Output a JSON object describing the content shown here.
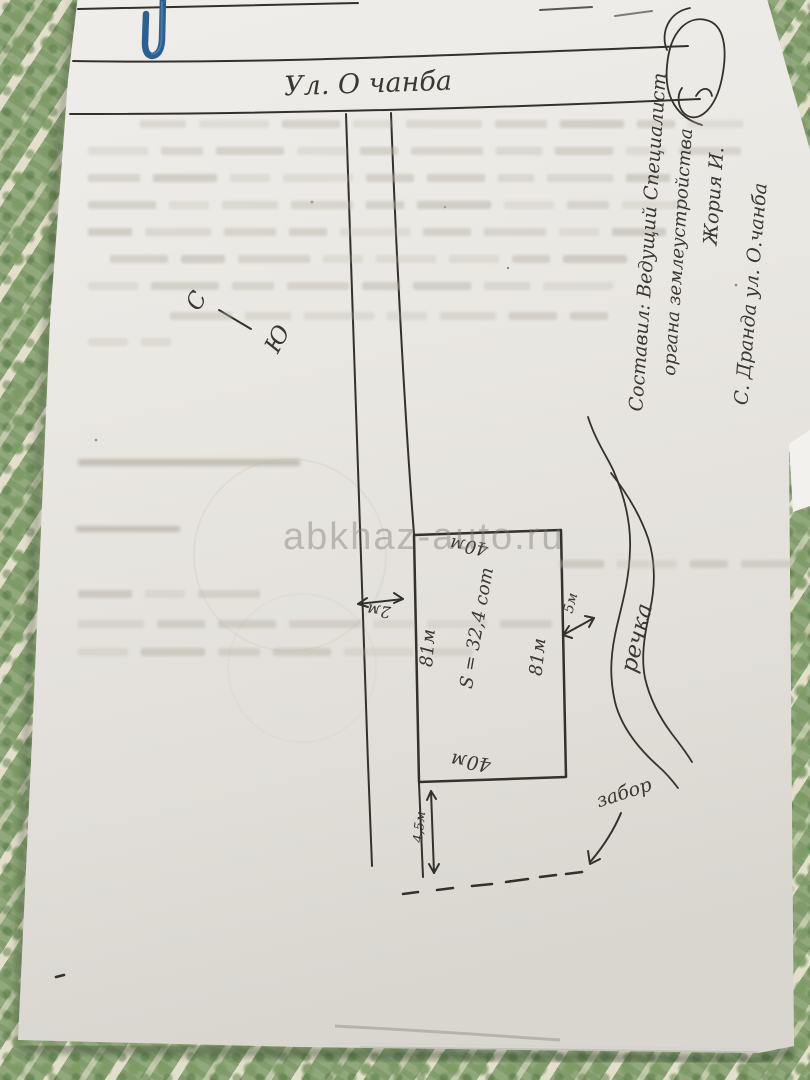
{
  "plan": {
    "street_label": "Ул. О чанба",
    "compass": {
      "north_label": "С",
      "south_label": "Ю"
    },
    "road_width_label": "2м",
    "plot": {
      "width_top_label": "40м",
      "width_bottom_label": "40м",
      "height_left_label": "81м",
      "height_right_label": "81м",
      "area_label": "S = 32,4 сот"
    },
    "river_label": "речка",
    "river_distance_label": "5м",
    "fence_label": "забор",
    "fence_distance_label": "4,5м",
    "author_block": {
      "line1": "Составил: Ведущий Специалист",
      "line2": "органа землеустройства",
      "line3": "Жория И.",
      "line4": "С. Дранда ул. О.чанба"
    }
  },
  "watermark": {
    "text": "abkhaz-auto.ru"
  },
  "colors": {
    "ink": "#34312c",
    "paper": "#e9e7e2",
    "fabric_green": "#8ca677",
    "clip_blue": "#2c6090",
    "watermark_gray": "#7d7d7d"
  }
}
